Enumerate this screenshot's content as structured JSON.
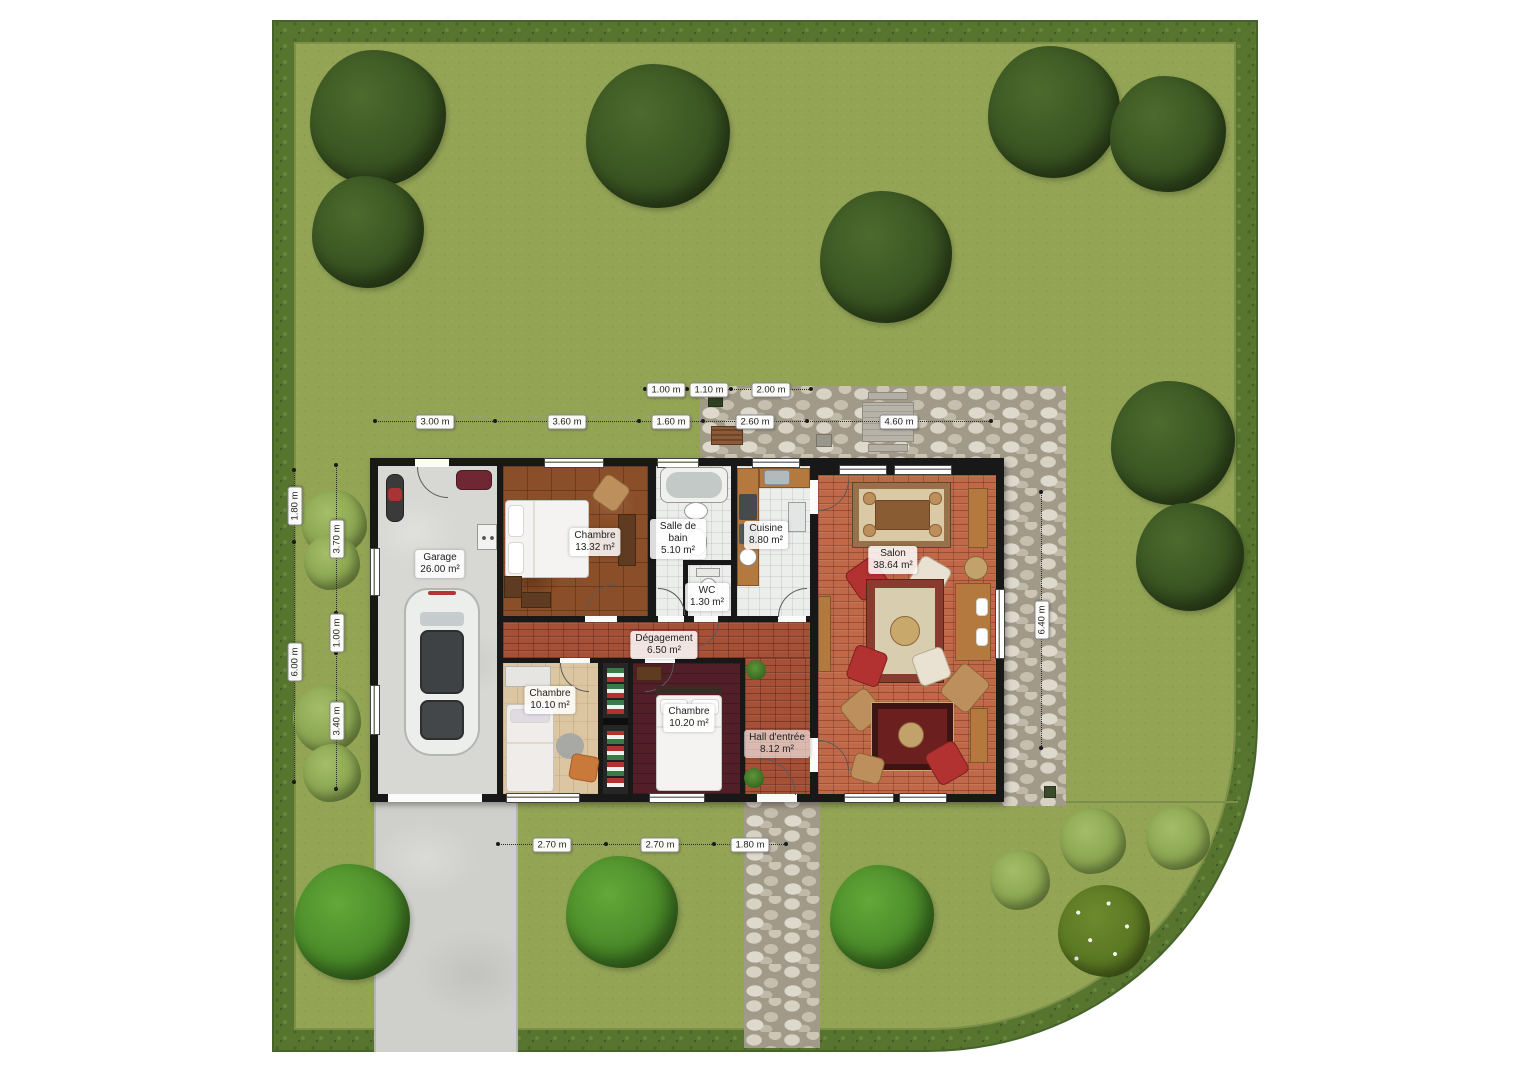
{
  "plan": {
    "type": "Plan de rez-de-chaussée avec jardin",
    "total_rooms": 10
  },
  "rooms": [
    {
      "id": "garage",
      "name": "Garage",
      "area": "26.00 m²"
    },
    {
      "id": "chambre-1",
      "name": "Chambre",
      "area": "13.32 m²"
    },
    {
      "id": "salle-de-bain",
      "name": "Salle de bain",
      "area": "5.10 m²"
    },
    {
      "id": "cuisine",
      "name": "Cuisine",
      "area": "8.80 m²"
    },
    {
      "id": "wc",
      "name": "WC",
      "area": "1.30 m²"
    },
    {
      "id": "salon",
      "name": "Salon",
      "area": "38.64 m²"
    },
    {
      "id": "degagement",
      "name": "Dégagement",
      "area": "6.50 m²"
    },
    {
      "id": "chambre-2",
      "name": "Chambre",
      "area": "10.10 m²"
    },
    {
      "id": "chambre-3",
      "name": "Chambre",
      "area": "10.20 m²"
    },
    {
      "id": "hall-entree",
      "name": "Hall d'entrée",
      "area": "8.12 m²"
    }
  ],
  "dimensions": {
    "top_inner": [
      "1.00 m",
      "1.10 m",
      "2.00 m"
    ],
    "top_outer": [
      "3.00 m",
      "3.60 m",
      "1.60 m",
      "2.60 m",
      "4.60 m"
    ],
    "left_outer": [
      "1.80 m",
      "6.00 m"
    ],
    "left_inner": [
      "3.70 m",
      "1.00 m",
      "3.40 m"
    ],
    "right_side": [
      "6.40 m"
    ],
    "bottom": [
      "2.70 m",
      "2.70 m",
      "1.80 m"
    ]
  },
  "colors": {
    "lawn": "#93a455",
    "hedge": "#57752f",
    "wall": "#181818",
    "brick_hall": "#a65038",
    "brick_salon": "#c06848",
    "stone_terrace": "#cdc6b6",
    "driveway": "#cfcfcb",
    "bedroom_wood": "#8a4e28",
    "bedroom_dark_floor": "#521e28"
  }
}
